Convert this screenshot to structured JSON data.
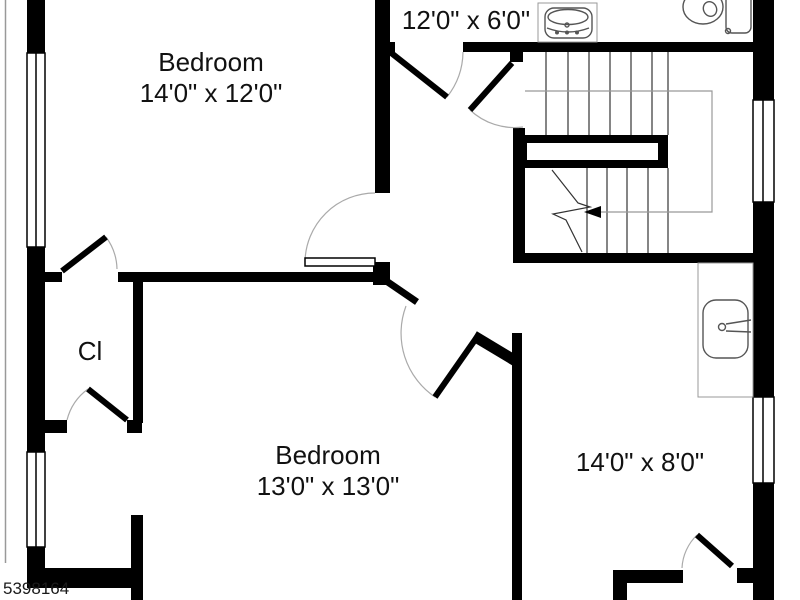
{
  "plan": {
    "type": "floor-plan",
    "colors": {
      "wall": "#000000",
      "floor": "#ffffff",
      "door_arc": "#aaaaaa",
      "fixture_outline": "#555555",
      "text": "#111111"
    },
    "rooms": {
      "bedroom_top": {
        "name": "Bedroom",
        "dims": "14'0\" x 12'0\""
      },
      "bath_top": {
        "dims": "12'0\" x 6'0\""
      },
      "closet": {
        "abbr": "Cl"
      },
      "bedroom_bottom": {
        "name": "Bedroom",
        "dims": "13'0\" x 13'0\""
      },
      "room_right": {
        "dims": "14'0\" x 8'0\""
      }
    },
    "stairs": {
      "shape": "u-shaped",
      "direction_arrow": "left"
    },
    "fixtures": [
      "toilet",
      "vanity-sink",
      "bathroom-sink"
    ],
    "watermark": {
      "id": "5398164"
    }
  }
}
